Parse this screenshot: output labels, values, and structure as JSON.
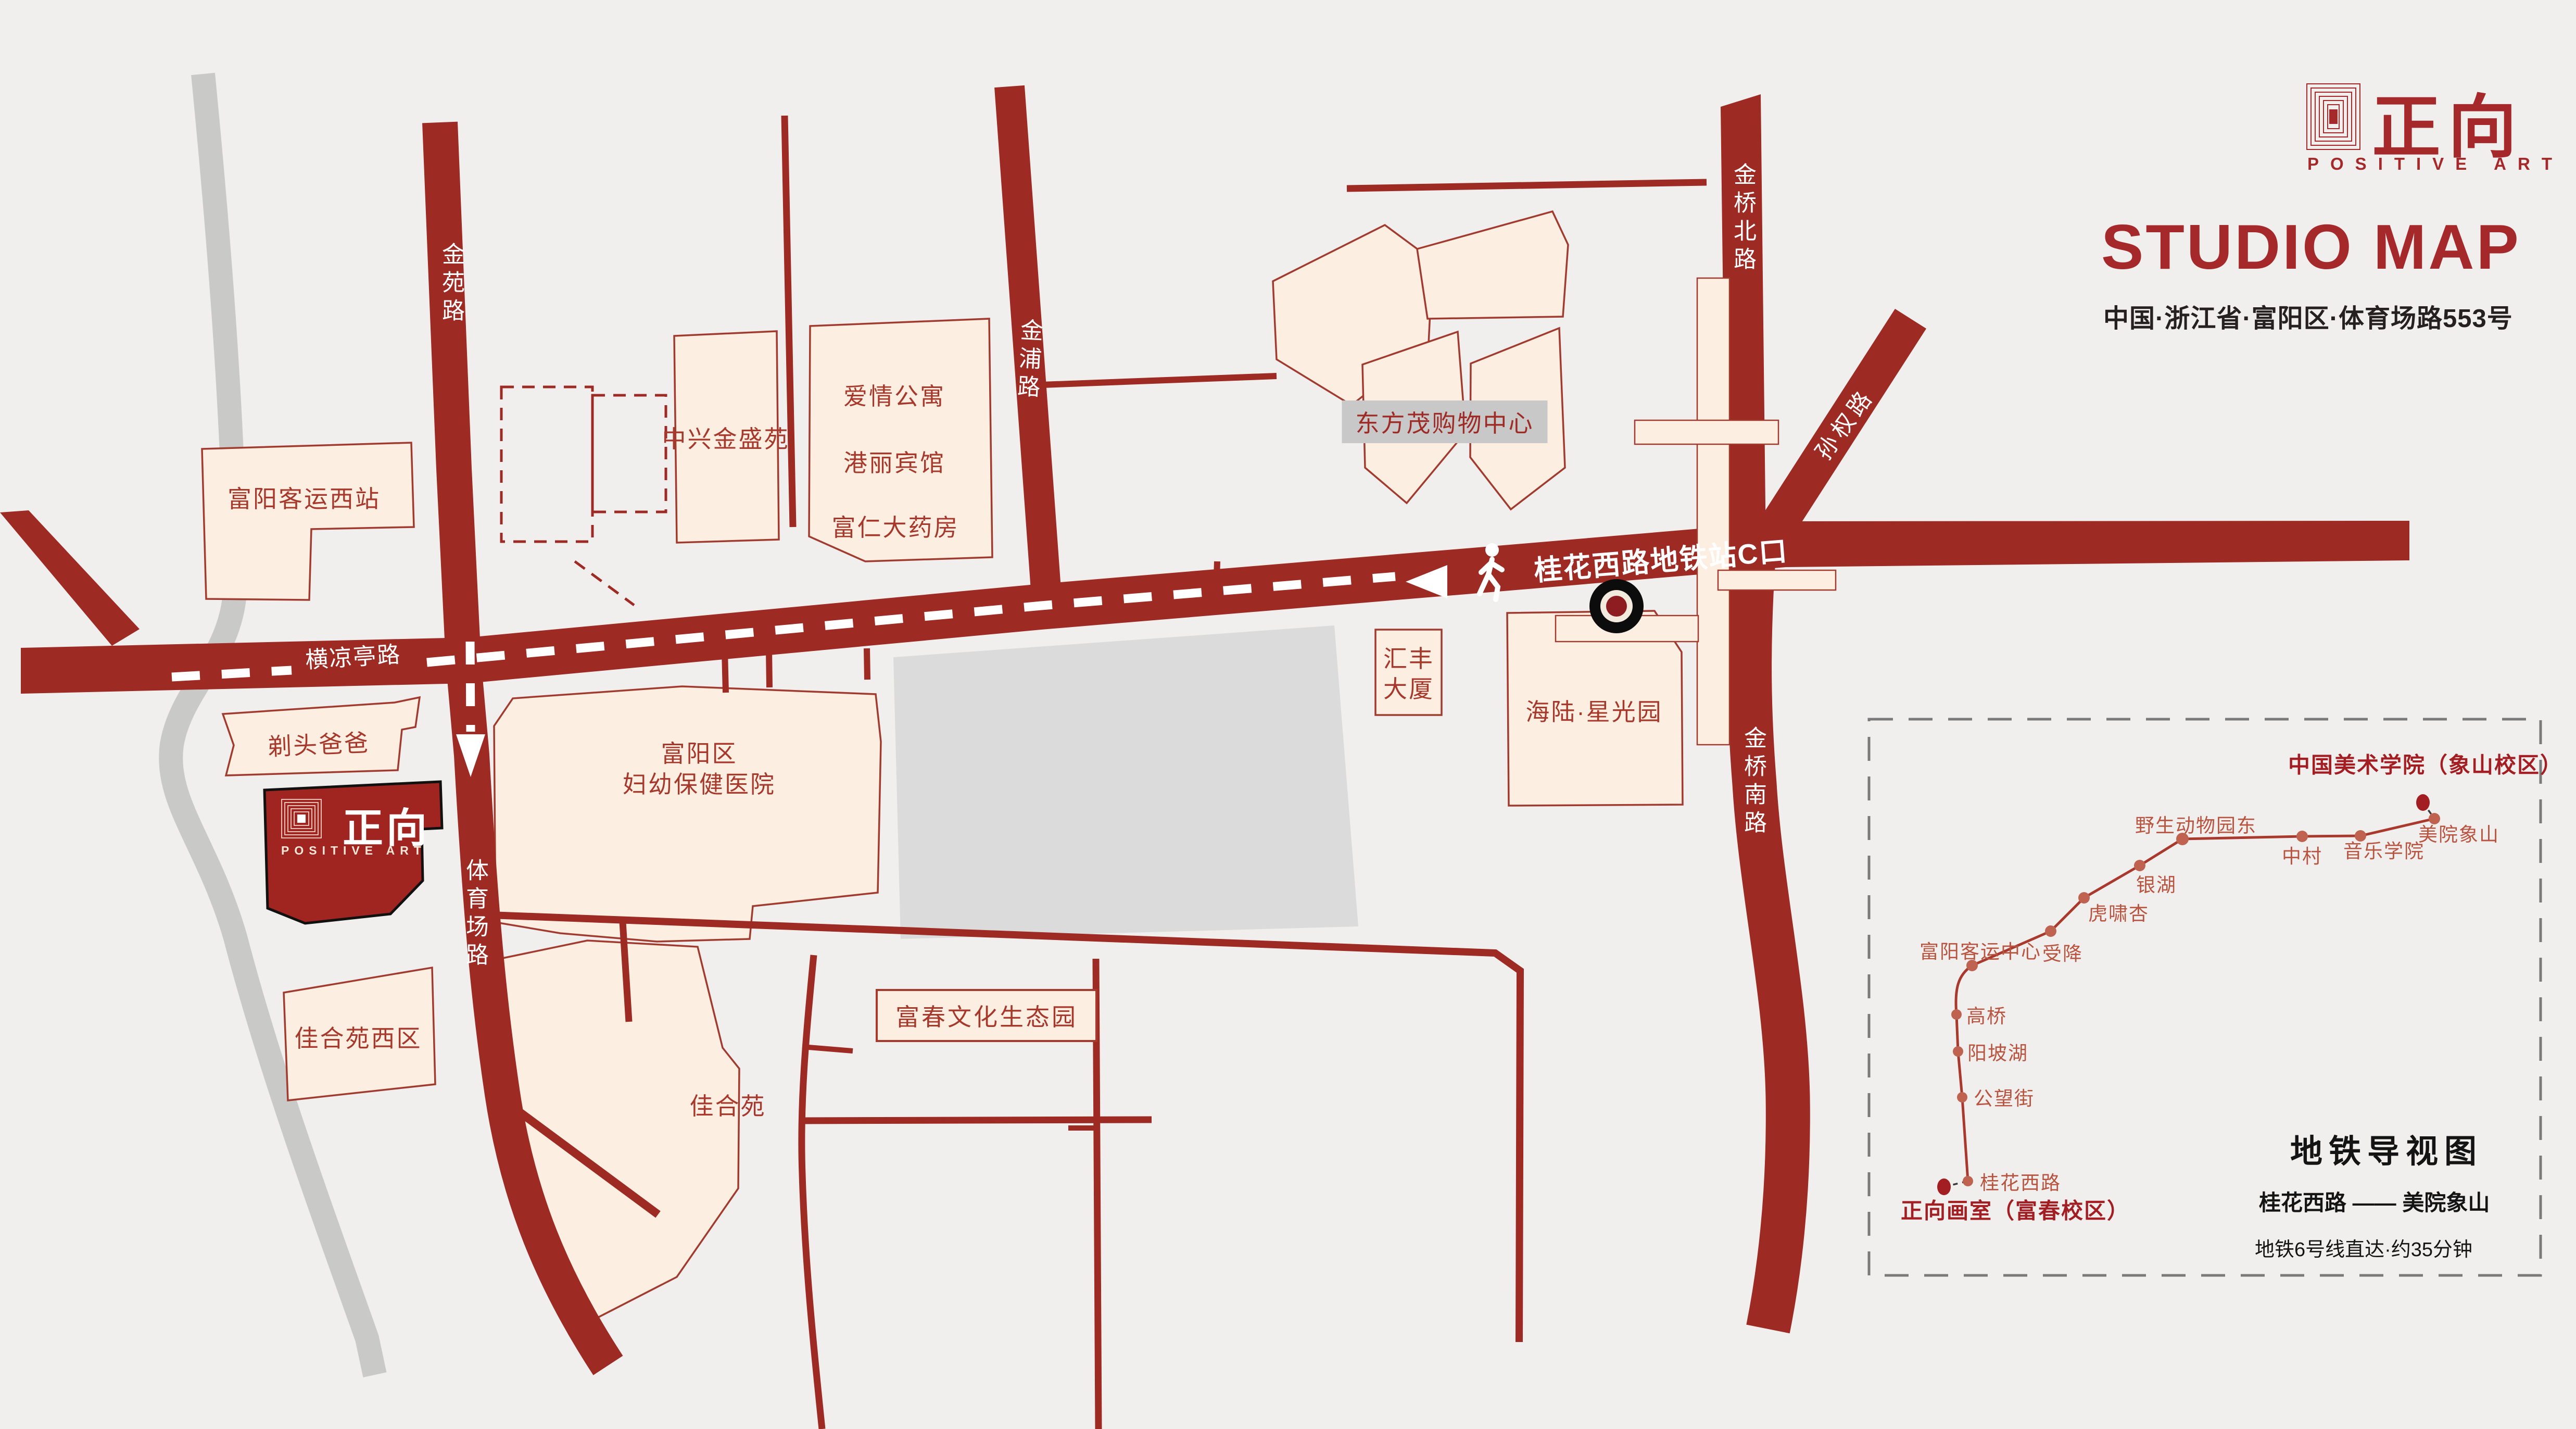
{
  "header": {
    "brand_cn": "正向",
    "brand_en": "POSITIVE ART",
    "title": "STUDIO MAP",
    "address": "中国·浙江省·富阳区·体育场路553号"
  },
  "studio_logo": {
    "brand_cn": "正向",
    "brand_en": "POSITIVE ART"
  },
  "map": {
    "roads": {
      "jinyuan": "金苑路",
      "hengliangting": "横凉亭路",
      "tiyuchang": "体育场路",
      "jinpu": "金浦路",
      "jinqiaobei": "金桥北路",
      "sunquan": "孙权路",
      "jinqiaonan": "金桥南路"
    },
    "route_label": "桂花西路地铁站C口",
    "buildings": {
      "keyun_xizhan": "富阳客运西站",
      "zhongxing": "中兴金盛苑",
      "aiqing": "爱情公寓",
      "gangli": "港丽宾馆",
      "furen": "富仁大药房",
      "dongfangmao": "东方茂购物中心",
      "huifeng_l1": "汇丰",
      "huifeng_l2": "大厦",
      "hailu": "海陆·星光园",
      "hospital_l1": "富阳区",
      "hospital_l2": "妇幼保健医院",
      "titou": "剃头爸爸",
      "jiaheyuan_xi": "佳合苑西区",
      "jiaheyuan": "佳合苑",
      "fuchun": "富春文化生态园"
    }
  },
  "metro": {
    "title": "地铁导视图",
    "route": "桂花西路 —— 美院象山",
    "note": "地铁6号线直达·约35分钟",
    "start": "正向画室（富春校区）",
    "end": "中国美术学院（象山校区）",
    "stations": [
      "桂花西路",
      "公望街",
      "阳坡湖",
      "高桥",
      "富阳客运中心",
      "受降",
      "虎啸杏",
      "银湖",
      "野生动物园东",
      "中村",
      "音乐学院",
      "美院象山"
    ]
  }
}
